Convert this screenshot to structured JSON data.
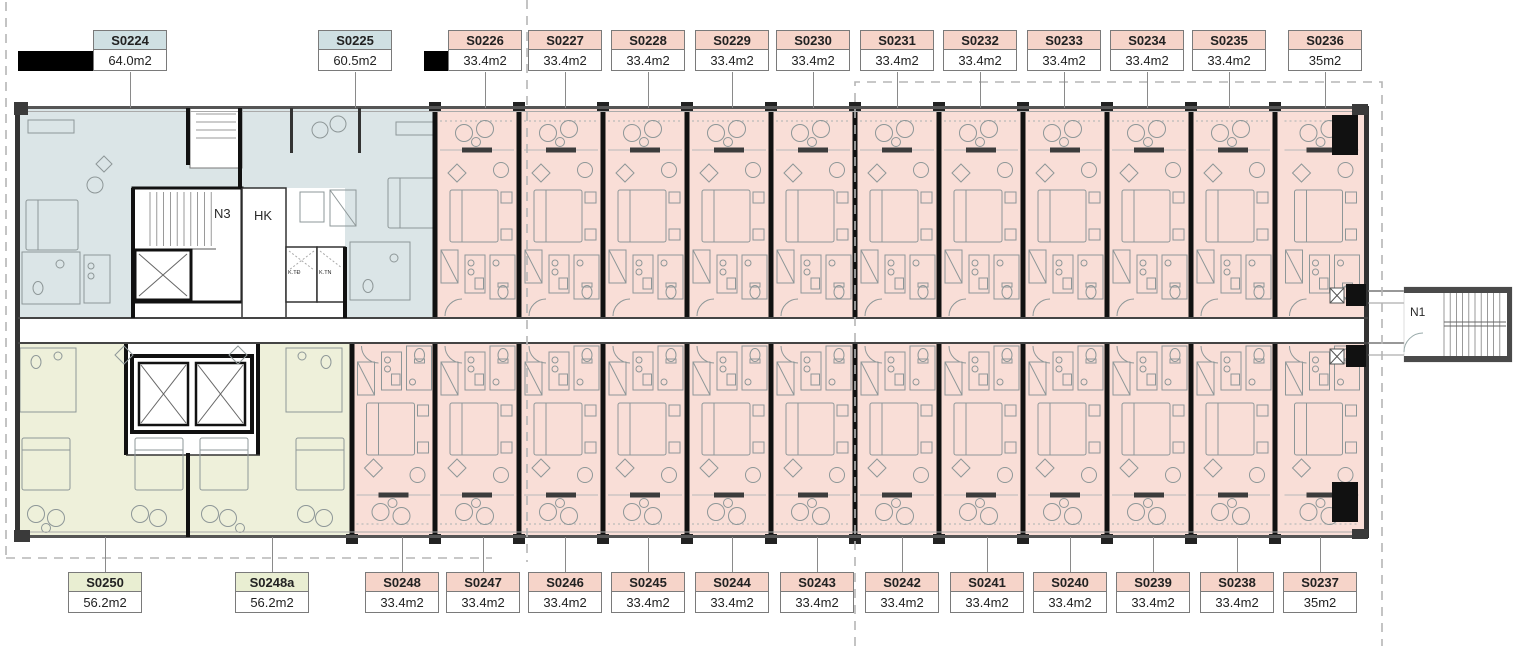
{
  "canvas": {
    "width": 1536,
    "height": 646,
    "background": "#ffffff"
  },
  "colors": {
    "zone_fills": {
      "blue": "#dbe5e7",
      "green": "#eef0da",
      "pink": "#f9ded7"
    },
    "header_fills": {
      "blue": "#cfe0e3",
      "green": "#e9eed2",
      "pink": "#f6d4c9"
    },
    "area_fill": "#ffffff",
    "label_border": "#7a7a7a",
    "label_text": "#222222",
    "wall_dark": "#111111",
    "wall_gray": "#555555",
    "furniture_stroke": "#8e9798",
    "leader": "#8a8a8a",
    "boundary_dash": "#b5b5b5"
  },
  "core_labels": {
    "stair_core": "N3",
    "housekeeping": "HK",
    "tech_electric": "K.TĐ",
    "tech_water": "K.TN",
    "stair_exterior": "N1"
  },
  "units_top": [
    {
      "id": "S0224",
      "area": "64.0m2",
      "zone": "blue",
      "label_cx": 130,
      "x0": 18,
      "x1": 240
    },
    {
      "id": "S0225",
      "area": "60.5m2",
      "zone": "blue",
      "label_cx": 355,
      "x0": 240,
      "x1": 435
    },
    {
      "id": "S0226",
      "area": "33.4m2",
      "zone": "pink",
      "label_cx": 485,
      "x0": 435,
      "x1": 519
    },
    {
      "id": "S0227",
      "area": "33.4m2",
      "zone": "pink",
      "label_cx": 565,
      "x0": 519,
      "x1": 603
    },
    {
      "id": "S0228",
      "area": "33.4m2",
      "zone": "pink",
      "label_cx": 648,
      "x0": 603,
      "x1": 687
    },
    {
      "id": "S0229",
      "area": "33.4m2",
      "zone": "pink",
      "label_cx": 732,
      "x0": 687,
      "x1": 771
    },
    {
      "id": "S0230",
      "area": "33.4m2",
      "zone": "pink",
      "label_cx": 813,
      "x0": 771,
      "x1": 855
    },
    {
      "id": "S0231",
      "area": "33.4m2",
      "zone": "pink",
      "label_cx": 897,
      "x0": 855,
      "x1": 939
    },
    {
      "id": "S0232",
      "area": "33.4m2",
      "zone": "pink",
      "label_cx": 980,
      "x0": 939,
      "x1": 1023
    },
    {
      "id": "S0233",
      "area": "33.4m2",
      "zone": "pink",
      "label_cx": 1064,
      "x0": 1023,
      "x1": 1107
    },
    {
      "id": "S0234",
      "area": "33.4m2",
      "zone": "pink",
      "label_cx": 1147,
      "x0": 1107,
      "x1": 1191
    },
    {
      "id": "S0235",
      "area": "33.4m2",
      "zone": "pink",
      "label_cx": 1229,
      "x0": 1191,
      "x1": 1275
    },
    {
      "id": "S0236",
      "area": "35m2",
      "zone": "pink",
      "label_cx": 1325,
      "x0": 1275,
      "x1": 1368
    }
  ],
  "units_bottom": [
    {
      "id": "S0250",
      "area": "56.2m2",
      "zone": "green",
      "label_cx": 105,
      "x0": 18,
      "x1": 188
    },
    {
      "id": "S0248a",
      "area": "56.2m2",
      "zone": "green",
      "label_cx": 272,
      "x0": 188,
      "x1": 352
    },
    {
      "id": "S0248",
      "area": "33.4m2",
      "zone": "pink",
      "label_cx": 402,
      "x0": 352,
      "x1": 435
    },
    {
      "id": "S0247",
      "area": "33.4m2",
      "zone": "pink",
      "label_cx": 483,
      "x0": 435,
      "x1": 519
    },
    {
      "id": "S0246",
      "area": "33.4m2",
      "zone": "pink",
      "label_cx": 565,
      "x0": 519,
      "x1": 603
    },
    {
      "id": "S0245",
      "area": "33.4m2",
      "zone": "pink",
      "label_cx": 648,
      "x0": 603,
      "x1": 687
    },
    {
      "id": "S0244",
      "area": "33.4m2",
      "zone": "pink",
      "label_cx": 732,
      "x0": 687,
      "x1": 771
    },
    {
      "id": "S0243",
      "area": "33.4m2",
      "zone": "pink",
      "label_cx": 817,
      "x0": 771,
      "x1": 855
    },
    {
      "id": "S0242",
      "area": "33.4m2",
      "zone": "pink",
      "label_cx": 902,
      "x0": 855,
      "x1": 939
    },
    {
      "id": "S0241",
      "area": "33.4m2",
      "zone": "pink",
      "label_cx": 987,
      "x0": 939,
      "x1": 1023
    },
    {
      "id": "S0240",
      "area": "33.4m2",
      "zone": "pink",
      "label_cx": 1070,
      "x0": 1023,
      "x1": 1107
    },
    {
      "id": "S0239",
      "area": "33.4m2",
      "zone": "pink",
      "label_cx": 1153,
      "x0": 1107,
      "x1": 1191
    },
    {
      "id": "S0238",
      "area": "33.4m2",
      "zone": "pink",
      "label_cx": 1237,
      "x0": 1191,
      "x1": 1275
    },
    {
      "id": "S0237",
      "area": "35m2",
      "zone": "pink",
      "label_cx": 1320,
      "x0": 1275,
      "x1": 1368
    }
  ]
}
